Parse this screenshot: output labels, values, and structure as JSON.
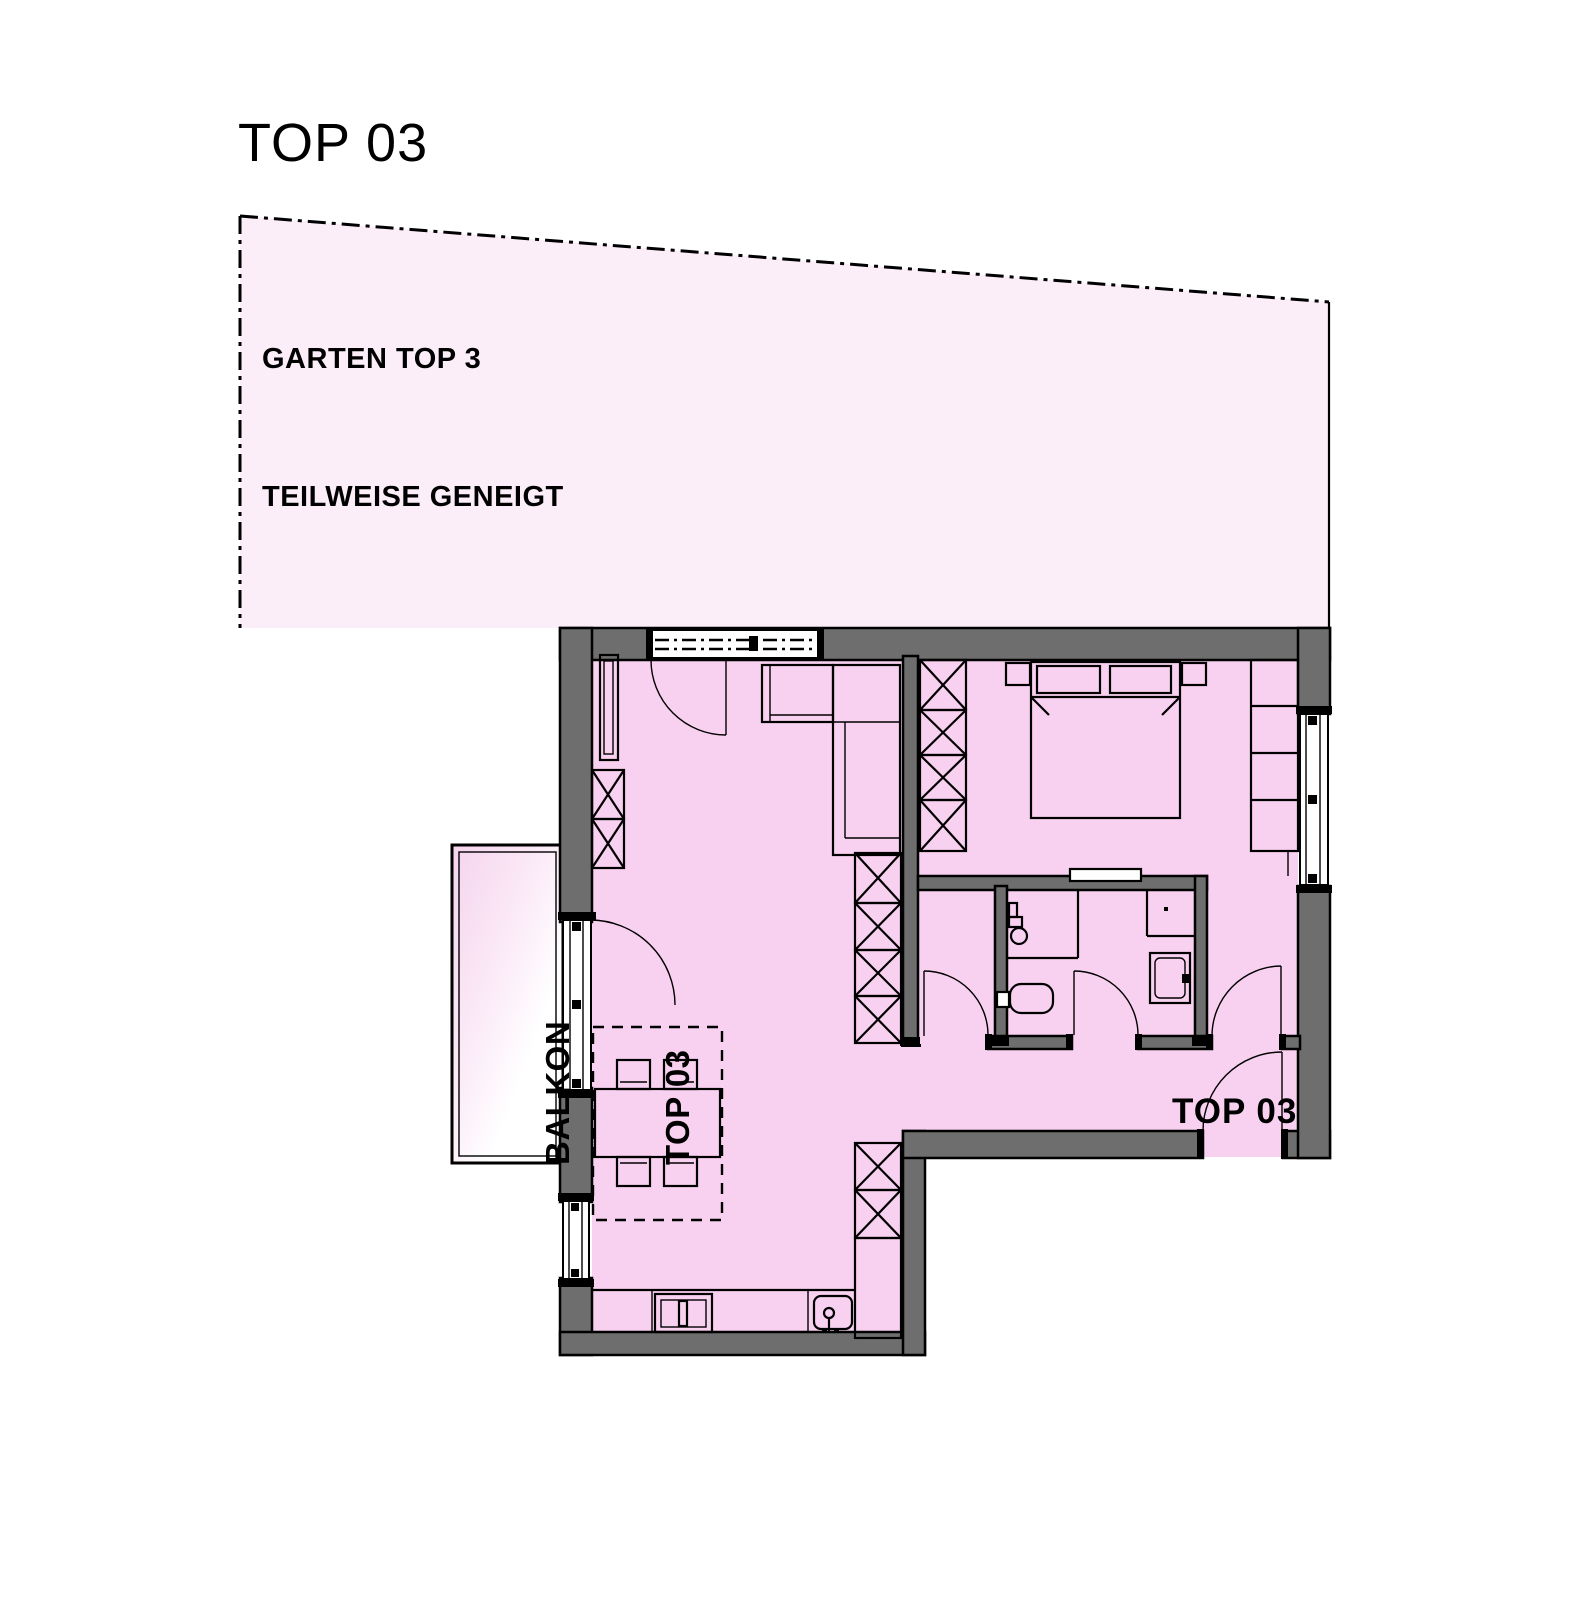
{
  "title": "TOP 03",
  "garden": {
    "line1": "GARTEN TOP 3",
    "line2": "TEILWEISE GENEIGT"
  },
  "balcony": {
    "line1": "BALKON",
    "line2": "TOP 03"
  },
  "unit": {
    "label": "TOP 03"
  },
  "colors": {
    "room_fill": "#f8d0f0",
    "garden_fill": "#fceef9",
    "wall_fill": "#6f6e6e",
    "line": "#000000"
  }
}
